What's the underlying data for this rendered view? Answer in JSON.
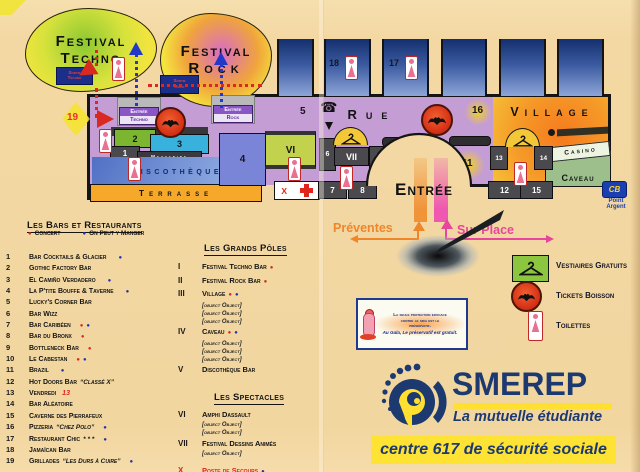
{
  "colors": {
    "background": "#f3d8a3",
    "hall_purple": "#c49dd4",
    "navy": "#1d3a70",
    "yellow": "#ffe334",
    "orange": "#f0862a",
    "magenta": "#e8459c",
    "concert_red": "#d8281e",
    "manger_blue": "#2333b0",
    "village_orange": "#f57a1e",
    "caveau_green": "#9cbf8c",
    "stand_blue": "#1e3a7a"
  },
  "map": {
    "blobs": {
      "ft1": "Festival",
      "ft2": "Techno",
      "fr1": "Festival",
      "fr2": "Rock"
    },
    "signs": {
      "sortie_techno1": "Sortie",
      "sortie_techno2": "Techno",
      "sortie_rock1": "Sortie",
      "sortie_rock2": "Rock",
      "entree_techno1": "Entrée",
      "entree_techno2": "Techno",
      "entree_rock1": "Entrée",
      "entree_rock2": "Rock"
    },
    "labels": {
      "rue": "Rue",
      "village": "Village",
      "discotheque": "Discothèque",
      "terrasse": "Terrasse",
      "mezzanine": "Mezzanine",
      "casino": "Casino",
      "caveau": "Caveau",
      "entree": "Entrée",
      "first_aid": "X",
      "cb": "CB",
      "point1": "Point",
      "point2": "Argent"
    },
    "rooms": {
      "n1": "1",
      "n2": "2",
      "n3": "3",
      "n4": "4",
      "n5": "5",
      "n6": "6",
      "n7": "7",
      "n8": "8",
      "n9": "9",
      "n10": "10",
      "n11": "11",
      "n12": "12",
      "n13": "13",
      "n14": "14",
      "n15": "15",
      "n16": "16",
      "n17": "17",
      "n18": "18",
      "n19": "19",
      "vi": "VI",
      "vii": "VII"
    },
    "arrows": {
      "preventes": "Préventes",
      "sur_place": "Sur Place"
    }
  },
  "bars": {
    "title": "Les Bars et Restaurants",
    "legend": {
      "concert": "Concert",
      "manger": "On Peut y Manger"
    },
    "items": [
      {
        "num": "1",
        "name": "Bar Cocktails & Glacier",
        "note": "",
        "noteRed": "",
        "c": "",
        "m": "●"
      },
      {
        "num": "2",
        "name": "Gothic Factory Bar",
        "note": "",
        "noteRed": "",
        "c": "",
        "m": ""
      },
      {
        "num": "3",
        "name": "El Camiño Verdadero",
        "note": "",
        "noteRed": "",
        "c": "",
        "m": "●"
      },
      {
        "num": "4",
        "name": "La P'tite Bouffe & Taverne",
        "note": "",
        "noteRed": "",
        "c": "",
        "m": "●"
      },
      {
        "num": "5",
        "name": "Lucky's Corner Bar",
        "note": "",
        "noteRed": "",
        "c": "",
        "m": ""
      },
      {
        "num": "6",
        "name": "Bar Wizz",
        "note": "",
        "noteRed": "",
        "c": "",
        "m": ""
      },
      {
        "num": "7",
        "name": "Bar Caribéen",
        "note": "",
        "noteRed": "",
        "c": "●",
        "m": "●"
      },
      {
        "num": "8",
        "name": "Bar du Bronx",
        "note": "",
        "noteRed": "",
        "c": "●",
        "m": ""
      },
      {
        "num": "9",
        "name": "Bottleneck Bar",
        "note": "",
        "noteRed": "",
        "c": "●",
        "m": ""
      },
      {
        "num": "10",
        "name": "Le Cabestan",
        "note": "",
        "noteRed": "",
        "c": "●",
        "m": "●"
      },
      {
        "num": "11",
        "name": "Brazil",
        "note": "",
        "noteRed": "",
        "c": "",
        "m": "●"
      },
      {
        "num": "12",
        "name": "Hot Doors Bar",
        "note": "“Classé X”",
        "noteRed": "",
        "c": "",
        "m": ""
      },
      {
        "num": "13",
        "name": "Vendredi",
        "note": "",
        "noteRed": "13",
        "c": "",
        "m": ""
      },
      {
        "num": "14",
        "name": "Bar Aléatoire",
        "note": "",
        "noteRed": "",
        "c": "",
        "m": ""
      },
      {
        "num": "15",
        "name": "Caverne des Pierrafeux",
        "note": "",
        "noteRed": "",
        "c": "",
        "m": ""
      },
      {
        "num": "16",
        "name": "Pizzeria",
        "note": "“Chez Polo”",
        "noteRed": "",
        "c": "",
        "m": "●"
      },
      {
        "num": "17",
        "name": "Restaurant Chic",
        "note": "* * *",
        "noteRed": "",
        "c": "",
        "m": "●"
      },
      {
        "num": "18",
        "name": "Jamaïcan Bar",
        "note": "",
        "noteRed": "",
        "c": "",
        "m": ""
      },
      {
        "num": "19",
        "name": "Grillades",
        "note": "“Les Durs à Cuire”",
        "noteRed": "",
        "c": "",
        "m": "●"
      }
    ]
  },
  "poles": {
    "title": "Les Grands Pôles",
    "items": [
      {
        "rn": "I",
        "name": "Festival Techno Bar",
        "c": "●",
        "m": "",
        "subs": []
      },
      {
        "rn": "II",
        "name": "Festival Rock Bar",
        "c": "●",
        "m": "",
        "subs": []
      },
      {
        "rn": "III",
        "name": "Village",
        "c": "●",
        "m": "●",
        "subs": [
          "- Bar “Pastis ô Maître”",
          "- Cave à Vins",
          "- Bar des Anciens"
        ]
      },
      {
        "rn": "IV",
        "name": "Caveau",
        "c": "●",
        "m": "●",
        "subs": [
          "- Bar “Champagne !”",
          "- Caveau Jazz",
          "- Concert Classique"
        ]
      },
      {
        "rn": "V",
        "name": "Discothèque Bar",
        "c": "",
        "m": "",
        "subs": []
      }
    ]
  },
  "spectacles": {
    "title": "Les Spectacles",
    "items": [
      {
        "rn": "VI",
        "name": "Amphi Dassault",
        "subs": [
          "- Avant Première",
          "- Festival Comique"
        ]
      },
      {
        "rn": "VII",
        "name": "Festival Dessins Animés",
        "subs": [
          "Non Stop !"
        ]
      }
    ],
    "secours": {
      "rn": "X",
      "name": "Poste de Secours",
      "m": "●"
    }
  },
  "legend": {
    "vestiaires": "Vestiaires Gratuits",
    "tickets": "Tickets Boisson",
    "toilettes": "Toilettes"
  },
  "sticker": {
    "l1": "La seule protection efficace",
    "l2": "contre le sida est le",
    "l3": "préservatif.",
    "l4": "Au Gala, Le préservatif est gratuit."
  },
  "smerep": {
    "name": "SMEREP",
    "tagline": "La mutuelle étudiante",
    "banner": "centre 617 de sécurité sociale"
  }
}
